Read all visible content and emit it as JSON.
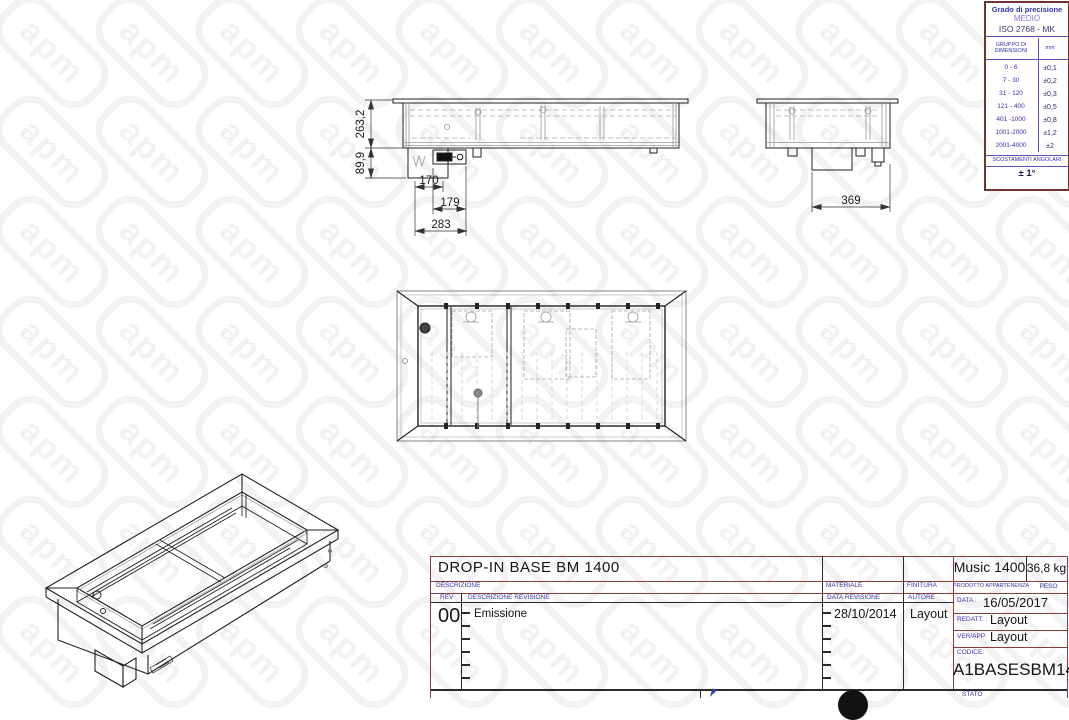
{
  "watermark": {
    "text": "apm"
  },
  "tolerance_table": {
    "title": "Grado di precisione",
    "grade": "MEDIO",
    "standard": "ISO 2768 - MK",
    "col1_header": "GRUPPO DI DIMENSIONI",
    "col2_header": "mm",
    "rows": [
      {
        "range": "0  -  6",
        "tol": "±0,1"
      },
      {
        "range": "7  -  30",
        "tol": "±0,2"
      },
      {
        "range": "31 - 120",
        "tol": "±0,3"
      },
      {
        "range": "121 - 400",
        "tol": "±0,5"
      },
      {
        "range": "401 -1000",
        "tol": "±0,8"
      },
      {
        "range": "1001-2000",
        "tol": "±1,2"
      },
      {
        "range": "2001-4000",
        "tol": "±2"
      }
    ],
    "angular_label": "SCOSTAMENTI ANGOLARI",
    "angular_value": "± 1°"
  },
  "views": {
    "front": {
      "dim_depth": "263,2",
      "dim_box_depth": "89,9",
      "dim_w1": "170",
      "dim_w2": "179",
      "dim_w3": "283"
    },
    "side": {
      "dim_w": "369"
    }
  },
  "title_block": {
    "title": "DROP-IN BASE BM 1400",
    "labels": {
      "descrizione": "DESCRIZIONE",
      "rev": "REV",
      "descrizione_revisione": "DESCRIZIONE REVISIONE",
      "materiale": "MATERIALE",
      "finitura": "FINITURA",
      "prodotto": "PRODOTTO APPARTENENZA",
      "peso": "PESO",
      "data_revisione": "DATA REVISIONE",
      "autore": "AUTORE",
      "data": "DATA :",
      "redatt": "REDATT. :",
      "verapp": "VER/APP.",
      "codice": "CODICE:",
      "stato": "STATO"
    },
    "values": {
      "product": "Music 1400",
      "weight": "36,8 kg",
      "rev": "00",
      "revision_desc": "Emissione",
      "revision_date": "28/10/2014",
      "author": "Layout",
      "date": "16/05/2017",
      "redatt": "Layout",
      "verapp": "Layout",
      "code": "A1BASESBM14"
    }
  }
}
